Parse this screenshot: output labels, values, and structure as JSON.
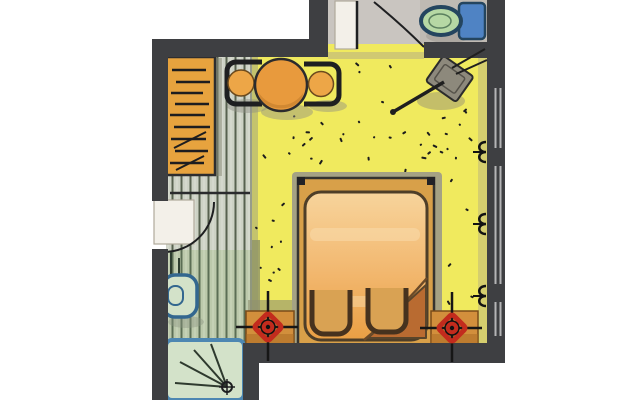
{
  "meta": {
    "subject": "hand-drawn hotel room floor plan, marker rendering, no text labels"
  },
  "colors": {
    "wall": "#3e3f42",
    "ink": "#1e1f21",
    "carpet": "#f0ea5e",
    "carpet_shade": "#98a074",
    "corridor_bg": "#cdd2c5",
    "corridor_line": "#57614f",
    "bath_bg": "#bcc9ab",
    "bath_line": "#5c6e55",
    "wardrobe": "#e7a33e",
    "table": "#e89a3d",
    "table_shade": "#c8802e",
    "seat": "#eda647",
    "bed_frame": "#d8a049",
    "bed_halo": "#a5a284",
    "bed_light": "#f7d49c",
    "bed_mid": "#f2b76e",
    "bed_dark": "#e99f44",
    "bed_under": "#b96b31",
    "stool": "#d9a253",
    "stool_line": "#46321e",
    "nightstand": "#d28f3c",
    "lamp_red": "#c22b1d",
    "wc_floor": "#c9c5c0",
    "door_leaf": "#f3f0e9",
    "toilet_green": "#b6d8a4",
    "toilet_blue": "#4f83c4",
    "toilet_navy": "#24455f",
    "shower_border": "#4d87b2",
    "shower_bg": "#d3e2c9",
    "tv_gray": "#8d897c",
    "window_line": "#b4b4b6",
    "shadow": "#8e8e82",
    "background": "#ffffff"
  },
  "rooms": [
    {
      "name": "main-room",
      "floor": "yellow speckled carpet",
      "items": [
        "double-bed",
        "folded-duvet-corner",
        "footstool-left",
        "footstool-right",
        "nightstand-left",
        "nightstand-right",
        "ceiling-lamp-symbol-left",
        "ceiling-lamp-symbol-right",
        "round-table",
        "armchair-left",
        "armchair-right",
        "corner-tv-with-arm",
        "wall-socket-symbols",
        "window-segments"
      ]
    },
    {
      "name": "entry-corridor",
      "floor": "striped planks",
      "items": [
        "wardrobe-with-hanger-marks",
        "entrance-door-swing"
      ]
    },
    {
      "name": "bathroom",
      "floor": "green striped tiles",
      "items": [
        "washbasin",
        "shower-tray-with-spray-symbol"
      ]
    },
    {
      "name": "wc-room",
      "floor": "grey tiles",
      "items": [
        "toilet-with-cistern",
        "swing-door"
      ]
    }
  ]
}
